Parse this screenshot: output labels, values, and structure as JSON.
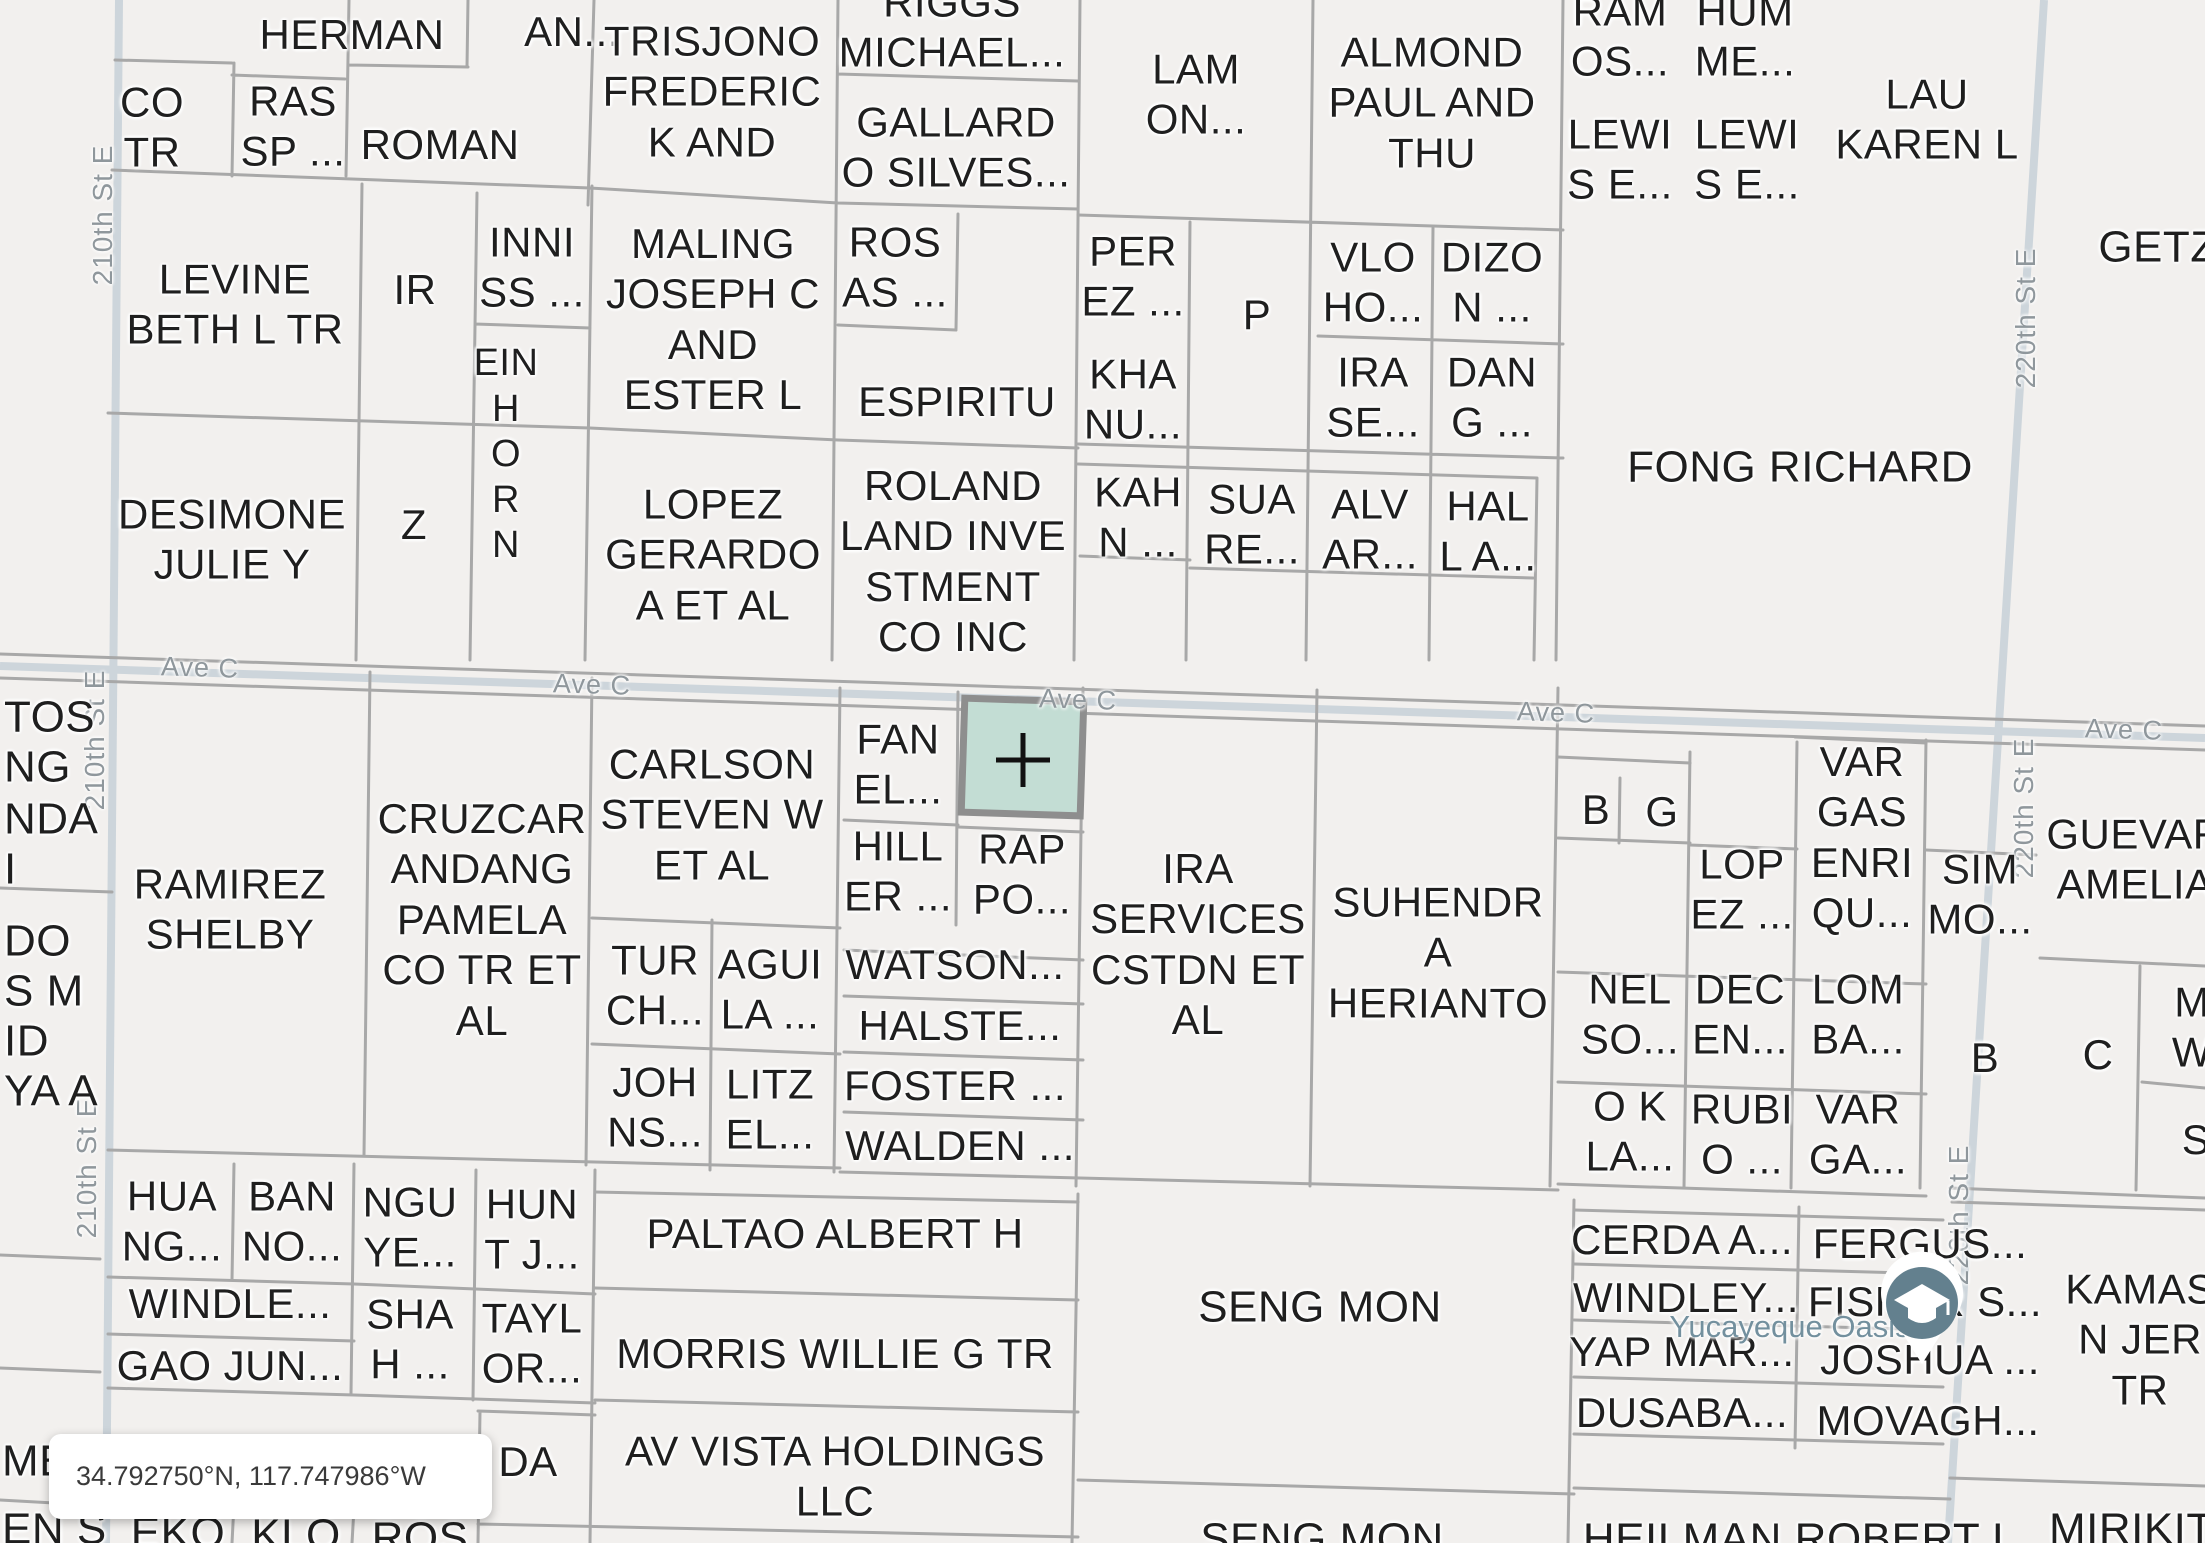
{
  "map": {
    "colors": {
      "background": "#f2f0ee",
      "parcel_line": "#a8a8a8",
      "road": "#cdd5db",
      "selected_parcel_fill": "#c3ddd4",
      "selected_parcel_border": "#8e8e8e",
      "label_text": "#1f1f1f",
      "street_label_text": "#8f979c",
      "place_label_text": "#73909e"
    },
    "selected_parcel": {
      "lines": [
        "MSC",
        "1 L..."
      ],
      "x": 1022,
      "y": 753
    },
    "coordinate_pill": {
      "text": "34.792750°N, 117.747986°W"
    },
    "place_label": {
      "text": "Yucayeque Oasis"
    },
    "street_labels": [
      {
        "text": "210th St E",
        "x": 103,
        "y": 215
      },
      {
        "text": "210th St E",
        "x": 95,
        "y": 740
      },
      {
        "text": "210th St E",
        "x": 87,
        "y": 1168
      },
      {
        "text": "220th St E",
        "x": 2026,
        "y": 318
      },
      {
        "text": "220th St E",
        "x": 2024,
        "y": 808
      },
      {
        "text": "220th St E",
        "x": 1959,
        "y": 1215
      }
    ],
    "ave_labels": [
      {
        "text": "Ave C",
        "x": 200,
        "y": 668
      },
      {
        "text": "Ave C",
        "x": 592,
        "y": 685
      },
      {
        "text": "Ave C",
        "x": 1078,
        "y": 700
      },
      {
        "text": "Ave C",
        "x": 1556,
        "y": 713
      },
      {
        "text": "Ave C",
        "x": 2124,
        "y": 730
      }
    ],
    "parcels": [
      {
        "id": "herman",
        "lines": [
          "HERMAN"
        ],
        "x": 352,
        "y": 35
      },
      {
        "id": "an",
        "lines": [
          "AN..."
        ],
        "x": 572,
        "y": 32
      },
      {
        "id": "co-tr",
        "lines": [
          "CO",
          "TR"
        ],
        "x": 152,
        "y": 128
      },
      {
        "id": "ras-sp",
        "lines": [
          "RAS",
          "SP ..."
        ],
        "x": 293,
        "y": 127
      },
      {
        "id": "roman",
        "lines": [
          "ROMAN"
        ],
        "x": 440,
        "y": 145
      },
      {
        "id": "trisjono",
        "lines": [
          "TRISJONO",
          "FREDERIC",
          "K AND"
        ],
        "x": 712,
        "y": 92
      },
      {
        "id": "riggs",
        "lines": [
          "RIGGS",
          "MICHAEL..."
        ],
        "x": 952,
        "y": 28
      },
      {
        "id": "gallardo",
        "lines": [
          "GALLARD",
          "O SILVES..."
        ],
        "x": 956,
        "y": 148
      },
      {
        "id": "lam",
        "lines": [
          "LAM",
          "ON..."
        ],
        "x": 1196,
        "y": 95
      },
      {
        "id": "almond",
        "lines": [
          "ALMOND",
          "PAUL AND",
          "THU"
        ],
        "x": 1432,
        "y": 103
      },
      {
        "id": "ramos",
        "lines": [
          "RAM",
          "OS..."
        ],
        "x": 1620,
        "y": 37
      },
      {
        "id": "humme",
        "lines": [
          "HUM",
          "ME..."
        ],
        "x": 1745,
        "y": 37
      },
      {
        "id": "lewis-e-1",
        "lines": [
          "LEWI",
          "S E..."
        ],
        "x": 1620,
        "y": 160
      },
      {
        "id": "lewis-e-2",
        "lines": [
          "LEWI",
          "S E..."
        ],
        "x": 1747,
        "y": 160
      },
      {
        "id": "lau",
        "lines": [
          "LAU",
          "KAREN L"
        ],
        "x": 1927,
        "y": 120
      },
      {
        "id": "getz",
        "lines": [
          "GETZ"
        ],
        "x": 2158,
        "y": 248,
        "fs": 44
      },
      {
        "id": "levine",
        "lines": [
          "LEVINE",
          "BETH L TR"
        ],
        "x": 235,
        "y": 305
      },
      {
        "id": "ir",
        "lines": [
          "IR"
        ],
        "x": 415,
        "y": 290
      },
      {
        "id": "inniss",
        "lines": [
          "INNI",
          "SS ..."
        ],
        "x": 532,
        "y": 268
      },
      {
        "id": "einhorn",
        "lines": [
          "EIN",
          "H",
          "O",
          "R",
          "N"
        ],
        "x": 506,
        "y": 455,
        "fs": 38
      },
      {
        "id": "maling",
        "lines": [
          "MALING",
          "JOSEPH C",
          "AND",
          "ESTER L"
        ],
        "x": 713,
        "y": 320
      },
      {
        "id": "rosas",
        "lines": [
          "ROS",
          "AS ..."
        ],
        "x": 895,
        "y": 268
      },
      {
        "id": "espiritu",
        "lines": [
          "ESPIRITU"
        ],
        "x": 957,
        "y": 402
      },
      {
        "id": "perez",
        "lines": [
          "PER",
          "EZ ..."
        ],
        "x": 1133,
        "y": 277
      },
      {
        "id": "p",
        "lines": [
          "P"
        ],
        "x": 1257,
        "y": 315
      },
      {
        "id": "khanu",
        "lines": [
          "KHA",
          "NU..."
        ],
        "x": 1133,
        "y": 400
      },
      {
        "id": "vloho",
        "lines": [
          "VLO",
          "HO..."
        ],
        "x": 1373,
        "y": 283
      },
      {
        "id": "dizon",
        "lines": [
          "DIZO",
          "N ..."
        ],
        "x": 1492,
        "y": 283
      },
      {
        "id": "irase",
        "lines": [
          "IRA",
          "SE..."
        ],
        "x": 1373,
        "y": 398
      },
      {
        "id": "dang",
        "lines": [
          "DAN",
          "G ..."
        ],
        "x": 1492,
        "y": 398
      },
      {
        "id": "fong",
        "lines": [
          "FONG RICHARD"
        ],
        "x": 1800,
        "y": 468,
        "fs": 44
      },
      {
        "id": "desimone",
        "lines": [
          "DESIMONE",
          "JULIE Y"
        ],
        "x": 232,
        "y": 540
      },
      {
        "id": "z",
        "lines": [
          "Z"
        ],
        "x": 414,
        "y": 525
      },
      {
        "id": "lopez-gerardo",
        "lines": [
          "LOPEZ",
          "GERARDO",
          "A ET AL"
        ],
        "x": 713,
        "y": 555
      },
      {
        "id": "roland",
        "lines": [
          "ROLAND",
          "LAND INVE",
          "STMENT",
          "CO INC"
        ],
        "x": 953,
        "y": 562
      },
      {
        "id": "kahn",
        "lines": [
          "KAH",
          "N ..."
        ],
        "x": 1138,
        "y": 518
      },
      {
        "id": "suare",
        "lines": [
          "SUA",
          "RE..."
        ],
        "x": 1252,
        "y": 525
      },
      {
        "id": "alvar",
        "lines": [
          "ALV",
          "AR..."
        ],
        "x": 1370,
        "y": 530
      },
      {
        "id": "hall",
        "lines": [
          "HAL",
          "L A..."
        ],
        "x": 1488,
        "y": 532
      },
      {
        "id": "tos",
        "lines": [
          "TOS"
        ],
        "x": 4,
        "y": 718,
        "anchor": "w",
        "fs": 44
      },
      {
        "id": "ng",
        "lines": [
          "NG"
        ],
        "x": 4,
        "y": 768,
        "anchor": "w",
        "fs": 44
      },
      {
        "id": "nda",
        "lines": [
          "NDA"
        ],
        "x": 4,
        "y": 820,
        "anchor": "w",
        "fs": 44
      },
      {
        "id": "i-part",
        "lines": [
          "I"
        ],
        "x": 4,
        "y": 870,
        "anchor": "w",
        "fs": 44
      },
      {
        "id": "do-part",
        "lines": [
          "DO"
        ],
        "x": 4,
        "y": 942,
        "anchor": "w",
        "fs": 44
      },
      {
        "id": "sm-part",
        "lines": [
          "S M"
        ],
        "x": 4,
        "y": 992,
        "anchor": "w",
        "fs": 44
      },
      {
        "id": "id-part",
        "lines": [
          "ID"
        ],
        "x": 4,
        "y": 1042,
        "anchor": "w",
        "fs": 44
      },
      {
        "id": "yaa-part",
        "lines": [
          "YA A"
        ],
        "x": 4,
        "y": 1092,
        "anchor": "w",
        "fs": 44
      },
      {
        "id": "ramirez",
        "lines": [
          "RAMIREZ",
          "SHELBY"
        ],
        "x": 230,
        "y": 910
      },
      {
        "id": "cruzcar",
        "lines": [
          "CRUZCAR",
          "ANDANG",
          "PAMELA",
          "CO TR ET",
          "AL"
        ],
        "x": 482,
        "y": 920
      },
      {
        "id": "carlson",
        "lines": [
          "CARLSON",
          "STEVEN W",
          "ET AL"
        ],
        "x": 712,
        "y": 815
      },
      {
        "id": "fanel",
        "lines": [
          "FAN",
          "EL..."
        ],
        "x": 898,
        "y": 765
      },
      {
        "id": "hiller",
        "lines": [
          "HILL",
          "ER ..."
        ],
        "x": 898,
        "y": 872
      },
      {
        "id": "rappo",
        "lines": [
          "RAP",
          "PO..."
        ],
        "x": 1022,
        "y": 875
      },
      {
        "id": "ira-services",
        "lines": [
          "IRA",
          "SERVICES",
          "CSTDN ET",
          "AL"
        ],
        "x": 1198,
        "y": 945
      },
      {
        "id": "suhendra",
        "lines": [
          "SUHENDR",
          "A",
          "HERIANTO"
        ],
        "x": 1438,
        "y": 953
      },
      {
        "id": "b1",
        "lines": [
          "B"
        ],
        "x": 1596,
        "y": 810
      },
      {
        "id": "g",
        "lines": [
          "G"
        ],
        "x": 1662,
        "y": 812
      },
      {
        "id": "lopez2",
        "lines": [
          "LOP",
          "EZ ..."
        ],
        "x": 1742,
        "y": 890
      },
      {
        "id": "vargas-enriqu",
        "lines": [
          "VAR",
          "GAS",
          "ENRI",
          "QU..."
        ],
        "x": 1862,
        "y": 838
      },
      {
        "id": "simmo",
        "lines": [
          "SIM",
          "MO..."
        ],
        "x": 1980,
        "y": 895
      },
      {
        "id": "guevar",
        "lines": [
          "GUEVAR",
          "AMELIA"
        ],
        "x": 2135,
        "y": 860
      },
      {
        "id": "nelso",
        "lines": [
          "NEL",
          "SO..."
        ],
        "x": 1630,
        "y": 1015
      },
      {
        "id": "decen",
        "lines": [
          "DEC",
          "EN..."
        ],
        "x": 1740,
        "y": 1015
      },
      {
        "id": "lomba",
        "lines": [
          "LOM",
          "BA..."
        ],
        "x": 1858,
        "y": 1015
      },
      {
        "id": "b2",
        "lines": [
          "B"
        ],
        "x": 1985,
        "y": 1058
      },
      {
        "id": "c",
        "lines": [
          "C"
        ],
        "x": 2098,
        "y": 1055
      },
      {
        "id": "mw-part",
        "lines": [
          "M",
          "W"
        ],
        "x": 2192,
        "y": 1028
      },
      {
        "id": "okla",
        "lines": [
          "O K",
          "LA..."
        ],
        "x": 1630,
        "y": 1132
      },
      {
        "id": "rubio",
        "lines": [
          "RUBI",
          "O ..."
        ],
        "x": 1742,
        "y": 1135
      },
      {
        "id": "varga",
        "lines": [
          "VAR",
          "GA..."
        ],
        "x": 1858,
        "y": 1135
      },
      {
        "id": "s-part",
        "lines": [
          "S"
        ],
        "x": 2196,
        "y": 1140
      },
      {
        "id": "turch",
        "lines": [
          "TUR",
          "CH..."
        ],
        "x": 655,
        "y": 986
      },
      {
        "id": "aguila",
        "lines": [
          "AGUI",
          "LA ..."
        ],
        "x": 770,
        "y": 990
      },
      {
        "id": "watson",
        "lines": [
          "WATSON..."
        ],
        "x": 955,
        "y": 965
      },
      {
        "id": "halste",
        "lines": [
          "HALSTE..."
        ],
        "x": 960,
        "y": 1026
      },
      {
        "id": "johns",
        "lines": [
          "JOH",
          "NS..."
        ],
        "x": 655,
        "y": 1108
      },
      {
        "id": "litzel",
        "lines": [
          "LITZ",
          "EL..."
        ],
        "x": 770,
        "y": 1110
      },
      {
        "id": "foster",
        "lines": [
          "FOSTER ..."
        ],
        "x": 955,
        "y": 1086
      },
      {
        "id": "walden",
        "lines": [
          "WALDEN ..."
        ],
        "x": 960,
        "y": 1146
      },
      {
        "id": "huang",
        "lines": [
          "HUA",
          "NG..."
        ],
        "x": 172,
        "y": 1222
      },
      {
        "id": "banno",
        "lines": [
          "BAN",
          "NO..."
        ],
        "x": 292,
        "y": 1222
      },
      {
        "id": "nguye",
        "lines": [
          "NGU",
          "YE..."
        ],
        "x": 410,
        "y": 1228
      },
      {
        "id": "huntj",
        "lines": [
          "HUN",
          "T J..."
        ],
        "x": 532,
        "y": 1230
      },
      {
        "id": "paltao",
        "lines": [
          "PALTAO ALBERT H"
        ],
        "x": 835,
        "y": 1234
      },
      {
        "id": "windle",
        "lines": [
          "WINDLE..."
        ],
        "x": 230,
        "y": 1304
      },
      {
        "id": "shah",
        "lines": [
          "SHA",
          "H ..."
        ],
        "x": 410,
        "y": 1340
      },
      {
        "id": "taylor",
        "lines": [
          "TAYL",
          "OR..."
        ],
        "x": 532,
        "y": 1344
      },
      {
        "id": "gaojun",
        "lines": [
          "GAO JUN..."
        ],
        "x": 230,
        "y": 1366
      },
      {
        "id": "morris",
        "lines": [
          "MORRIS WILLIE G TR"
        ],
        "x": 835,
        "y": 1354
      },
      {
        "id": "sengmon1",
        "lines": [
          "SENG MON"
        ],
        "x": 1320,
        "y": 1308,
        "fs": 44
      },
      {
        "id": "cerda",
        "lines": [
          "CERDA A..."
        ],
        "x": 1682,
        "y": 1240
      },
      {
        "id": "fergus",
        "lines": [
          "FERGUS..."
        ],
        "x": 1920,
        "y": 1244
      },
      {
        "id": "windley",
        "lines": [
          "WINDLEY..."
        ],
        "x": 1686,
        "y": 1298
      },
      {
        "id": "fisher",
        "lines": [
          "FISHER S..."
        ],
        "x": 1925,
        "y": 1302
      },
      {
        "id": "yapmar",
        "lines": [
          "YAP MAR..."
        ],
        "x": 1682,
        "y": 1352
      },
      {
        "id": "joshua",
        "lines": [
          "JOSHUA ..."
        ],
        "x": 1930,
        "y": 1360
      },
      {
        "id": "dusaba",
        "lines": [
          "DUSABA..."
        ],
        "x": 1682,
        "y": 1413
      },
      {
        "id": "movagh",
        "lines": [
          "MOVAGH..."
        ],
        "x": 1928,
        "y": 1421
      },
      {
        "id": "kamas",
        "lines": [
          "KAMAS",
          "N JER",
          "TR"
        ],
        "x": 2140,
        "y": 1340
      },
      {
        "id": "me-part",
        "lines": [
          "ME"
        ],
        "x": 2,
        "y": 1462,
        "anchor": "w",
        "fs": 44
      },
      {
        "id": "ens-part",
        "lines": [
          "EN S"
        ],
        "x": 2,
        "y": 1530,
        "anchor": "w",
        "fs": 44
      },
      {
        "id": "da",
        "lines": [
          "DA"
        ],
        "x": 528,
        "y": 1462
      },
      {
        "id": "avvista",
        "lines": [
          "AV VISTA HOLDINGS",
          "LLC"
        ],
        "x": 835,
        "y": 1477
      },
      {
        "id": "eko",
        "lines": [
          "EKO"
        ],
        "x": 178,
        "y": 1534,
        "fs": 44
      },
      {
        "id": "klo",
        "lines": [
          "KLO"
        ],
        "x": 296,
        "y": 1536,
        "fs": 44
      },
      {
        "id": "ros",
        "lines": [
          "ROS"
        ],
        "x": 420,
        "y": 1539,
        "fs": 44
      },
      {
        "id": "sengmon2",
        "lines": [
          "SENG MON"
        ],
        "x": 1322,
        "y": 1540,
        "fs": 44
      },
      {
        "id": "heilman",
        "lines": [
          "HEILMAN ROBERT L"
        ],
        "x": 1800,
        "y": 1540,
        "fs": 44
      },
      {
        "id": "mirikit",
        "lines": [
          "MIRIKIT..."
        ],
        "x": 2148,
        "y": 1530,
        "fs": 44
      }
    ]
  }
}
